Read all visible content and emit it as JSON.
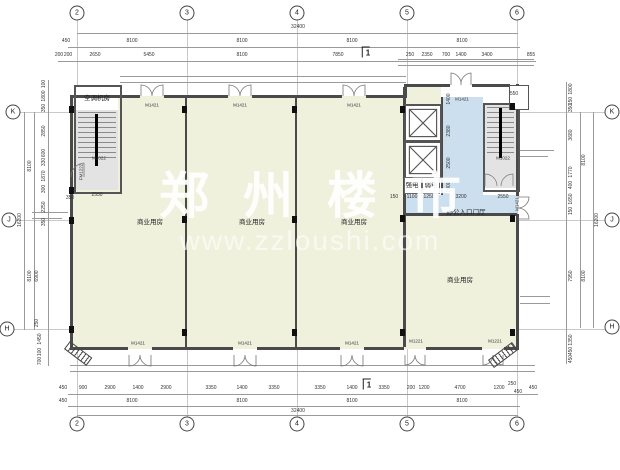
{
  "watermark": {
    "title": "郑州楼市",
    "url": "www.zzloushi.com"
  },
  "grid_bubbles": [
    {
      "t": "2",
      "x": 77,
      "y": 13
    },
    {
      "t": "3",
      "x": 187,
      "y": 13
    },
    {
      "t": "4",
      "x": 297,
      "y": 13
    },
    {
      "t": "5",
      "x": 407,
      "y": 13
    },
    {
      "t": "6",
      "x": 517,
      "y": 13
    },
    {
      "t": "2",
      "x": 77,
      "y": 424
    },
    {
      "t": "3",
      "x": 187,
      "y": 424
    },
    {
      "t": "4",
      "x": 297,
      "y": 424
    },
    {
      "t": "5",
      "x": 407,
      "y": 424
    },
    {
      "t": "6",
      "x": 517,
      "y": 424
    },
    {
      "t": "K",
      "x": 13,
      "y": 112
    },
    {
      "t": "J",
      "x": 9,
      "y": 220
    },
    {
      "t": "H",
      "x": 7,
      "y": 329
    },
    {
      "t": "K",
      "x": 612,
      "y": 112
    },
    {
      "t": "J",
      "x": 612,
      "y": 220
    },
    {
      "t": "H",
      "x": 612,
      "y": 327
    }
  ],
  "room_labels": [
    {
      "t": "空调机房",
      "x": 97,
      "y": 97
    },
    {
      "t": "商业用房",
      "x": 150,
      "y": 221
    },
    {
      "t": "商业用房",
      "x": 252,
      "y": 221
    },
    {
      "t": "商业用房",
      "x": 354,
      "y": 221
    },
    {
      "t": "商业用房",
      "x": 460,
      "y": 279
    },
    {
      "t": "办公入口门厅",
      "x": 466,
      "y": 211
    },
    {
      "t": "强电",
      "x": 412,
      "y": 184
    },
    {
      "t": "弱电",
      "x": 431,
      "y": 184
    }
  ],
  "door_labels": [
    {
      "t": "M1421",
      "x": 152,
      "y": 105
    },
    {
      "t": "M1421",
      "x": 240,
      "y": 105
    },
    {
      "t": "M1421",
      "x": 354,
      "y": 105
    },
    {
      "t": "M1421",
      "x": 462,
      "y": 99
    },
    {
      "t": "M1421",
      "x": 138,
      "y": 343
    },
    {
      "t": "M1421",
      "x": 245,
      "y": 343
    },
    {
      "t": "M1421",
      "x": 352,
      "y": 343
    },
    {
      "t": "M1221",
      "x": 416,
      "y": 341
    },
    {
      "t": "M1221",
      "x": 495,
      "y": 341
    },
    {
      "t": "M1421",
      "x": 517,
      "y": 204,
      "r": 1
    },
    {
      "t": "FM1222",
      "x": 81,
      "y": 172,
      "r": 1
    },
    {
      "t": "M1022",
      "x": 99,
      "y": 158
    },
    {
      "t": "M1022",
      "x": 503,
      "y": 158
    }
  ],
  "section_marks": [
    {
      "t": "1",
      "x": 366,
      "y": 52
    },
    {
      "t": "1",
      "x": 367,
      "y": 384
    }
  ],
  "dims": [
    {
      "t": "32400",
      "x": 298,
      "y": 27
    },
    {
      "t": "450",
      "x": 66,
      "y": 41
    },
    {
      "t": "8100",
      "x": 132,
      "y": 41
    },
    {
      "t": "8100",
      "x": 242,
      "y": 41
    },
    {
      "t": "8100",
      "x": 352,
      "y": 41
    },
    {
      "t": "8100",
      "x": 462,
      "y": 41
    },
    {
      "t": "200",
      "x": 59,
      "y": 55
    },
    {
      "t": "200",
      "x": 68,
      "y": 55
    },
    {
      "t": "2650",
      "x": 95,
      "y": 55
    },
    {
      "t": "5450",
      "x": 149,
      "y": 55
    },
    {
      "t": "8100",
      "x": 242,
      "y": 55
    },
    {
      "t": "7850",
      "x": 338,
      "y": 55
    },
    {
      "t": "250",
      "x": 410,
      "y": 55
    },
    {
      "t": "2350",
      "x": 427,
      "y": 55
    },
    {
      "t": "700",
      "x": 446,
      "y": 55
    },
    {
      "t": "1400",
      "x": 461,
      "y": 55
    },
    {
      "t": "3400",
      "x": 487,
      "y": 55
    },
    {
      "t": "855",
      "x": 531,
      "y": 55
    },
    {
      "t": "450",
      "x": 63,
      "y": 388
    },
    {
      "t": "900",
      "x": 83,
      "y": 388
    },
    {
      "t": "2900",
      "x": 110,
      "y": 388
    },
    {
      "t": "1400",
      "x": 138,
      "y": 388
    },
    {
      "t": "2900",
      "x": 166,
      "y": 388
    },
    {
      "t": "3350",
      "x": 211,
      "y": 388
    },
    {
      "t": "1400",
      "x": 242,
      "y": 388
    },
    {
      "t": "3350",
      "x": 274,
      "y": 388
    },
    {
      "t": "3350",
      "x": 320,
      "y": 388
    },
    {
      "t": "1400",
      "x": 352,
      "y": 388
    },
    {
      "t": "3350",
      "x": 384,
      "y": 388
    },
    {
      "t": "200",
      "x": 411,
      "y": 388
    },
    {
      "t": "1200",
      "x": 424,
      "y": 388
    },
    {
      "t": "4700",
      "x": 460,
      "y": 388
    },
    {
      "t": "1200",
      "x": 499,
      "y": 388
    },
    {
      "t": "250",
      "x": 512,
      "y": 384
    },
    {
      "t": "450",
      "x": 518,
      "y": 392
    },
    {
      "t": "450",
      "x": 533,
      "y": 388
    },
    {
      "t": "450",
      "x": 63,
      "y": 401
    },
    {
      "t": "8100",
      "x": 132,
      "y": 401
    },
    {
      "t": "8100",
      "x": 242,
      "y": 401
    },
    {
      "t": "8100",
      "x": 352,
      "y": 401
    },
    {
      "t": "8100",
      "x": 462,
      "y": 401
    },
    {
      "t": "32400",
      "x": 298,
      "y": 411
    },
    {
      "t": "100",
      "x": 44,
      "y": 84,
      "r": 1
    },
    {
      "t": "1800",
      "x": 44,
      "y": 96,
      "r": 1
    },
    {
      "t": "350",
      "x": 44,
      "y": 108,
      "r": 1
    },
    {
      "t": "2850",
      "x": 44,
      "y": 131,
      "r": 1
    },
    {
      "t": "600",
      "x": 44,
      "y": 153,
      "r": 1
    },
    {
      "t": "330",
      "x": 44,
      "y": 162,
      "r": 1
    },
    {
      "t": "1870",
      "x": 44,
      "y": 176,
      "r": 1
    },
    {
      "t": "300",
      "x": 44,
      "y": 189,
      "r": 1
    },
    {
      "t": "2250",
      "x": 44,
      "y": 207,
      "r": 1
    },
    {
      "t": "350",
      "x": 44,
      "y": 222,
      "r": 1
    },
    {
      "t": "6900",
      "x": 37,
      "y": 276,
      "r": 1
    },
    {
      "t": "250",
      "x": 37,
      "y": 323,
      "r": 1
    },
    {
      "t": "1450",
      "x": 40,
      "y": 339,
      "r": 1
    },
    {
      "t": "100",
      "x": 40,
      "y": 352,
      "r": 1
    },
    {
      "t": "700",
      "x": 40,
      "y": 361,
      "r": 1
    },
    {
      "t": "8100",
      "x": 30,
      "y": 166,
      "r": 1
    },
    {
      "t": "8100",
      "x": 30,
      "y": 276,
      "r": 1
    },
    {
      "t": "16200",
      "x": 20,
      "y": 220,
      "r": 1
    },
    {
      "t": "1800",
      "x": 571,
      "y": 89,
      "r": 1
    },
    {
      "t": "150",
      "x": 571,
      "y": 101,
      "r": 1
    },
    {
      "t": "350",
      "x": 571,
      "y": 108,
      "r": 1
    },
    {
      "t": "3680",
      "x": 571,
      "y": 135,
      "r": 1
    },
    {
      "t": "1770",
      "x": 571,
      "y": 172,
      "r": 1
    },
    {
      "t": "400",
      "x": 571,
      "y": 185,
      "r": 1
    },
    {
      "t": "1650",
      "x": 571,
      "y": 199,
      "r": 1
    },
    {
      "t": "150",
      "x": 571,
      "y": 211,
      "r": 1
    },
    {
      "t": "7950",
      "x": 571,
      "y": 276,
      "r": 1
    },
    {
      "t": "1350",
      "x": 571,
      "y": 340,
      "r": 1
    },
    {
      "t": "450",
      "x": 571,
      "y": 351,
      "r": 1
    },
    {
      "t": "450",
      "x": 571,
      "y": 359,
      "r": 1
    },
    {
      "t": "8100",
      "x": 584,
      "y": 160,
      "r": 1
    },
    {
      "t": "8100",
      "x": 584,
      "y": 276,
      "r": 1
    },
    {
      "t": "16200",
      "x": 597,
      "y": 220,
      "r": 1
    },
    {
      "t": "2550",
      "x": 97,
      "y": 195
    },
    {
      "t": "350",
      "x": 70,
      "y": 198
    },
    {
      "t": "150",
      "x": 394,
      "y": 197
    },
    {
      "t": "1100",
      "x": 412,
      "y": 197
    },
    {
      "t": "1250",
      "x": 429,
      "y": 197
    },
    {
      "t": "3200",
      "x": 461,
      "y": 197
    },
    {
      "t": "2550",
      "x": 503,
      "y": 197
    },
    {
      "t": "1400",
      "x": 449,
      "y": 99,
      "r": 1
    },
    {
      "t": "2380",
      "x": 449,
      "y": 131,
      "r": 1
    },
    {
      "t": "2500",
      "x": 449,
      "y": 163,
      "r": 1
    },
    {
      "t": "1000",
      "x": 449,
      "y": 187,
      "r": 1
    },
    {
      "t": "550",
      "x": 514,
      "y": 94
    }
  ]
}
